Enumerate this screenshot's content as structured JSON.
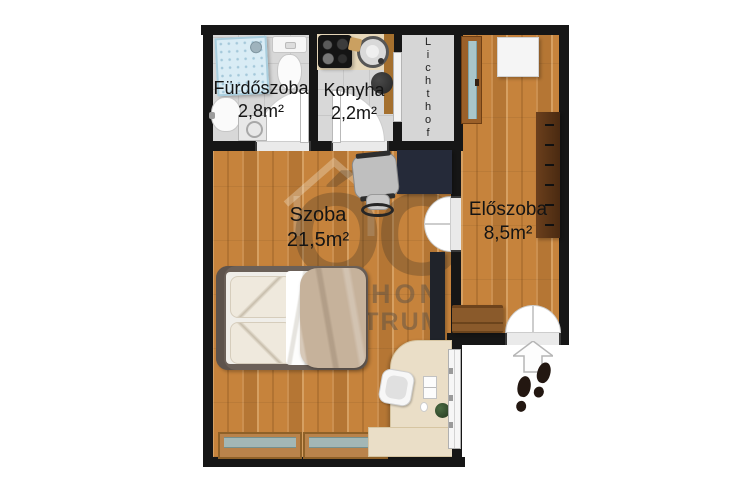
{
  "floorplan": {
    "rooms": {
      "bathroom": {
        "name": "Fürdőszoba",
        "area": "2,8m²"
      },
      "kitchen": {
        "name": "Konyha",
        "area": "2,2m²"
      },
      "room": {
        "name": "Szoba",
        "area": "21,5m²"
      },
      "hallway": {
        "name": "Előszoba",
        "area": "8,5m²"
      },
      "lightwell": {
        "name": "Lichthof"
      }
    },
    "watermark": {
      "monogram": "ÓC",
      "brand_line1": "OTTHON",
      "brand_line2": "CENTRUM"
    },
    "colors": {
      "wall": "#161616",
      "wood_floor": "#c6833c",
      "tile_floor": "#d8d8d8",
      "lightwell": "#d6d6d6",
      "wardrobe": "#5b3417",
      "duvet": "#c6b29b",
      "watermark_text": "rgba(92,82,70,0.52)"
    }
  }
}
